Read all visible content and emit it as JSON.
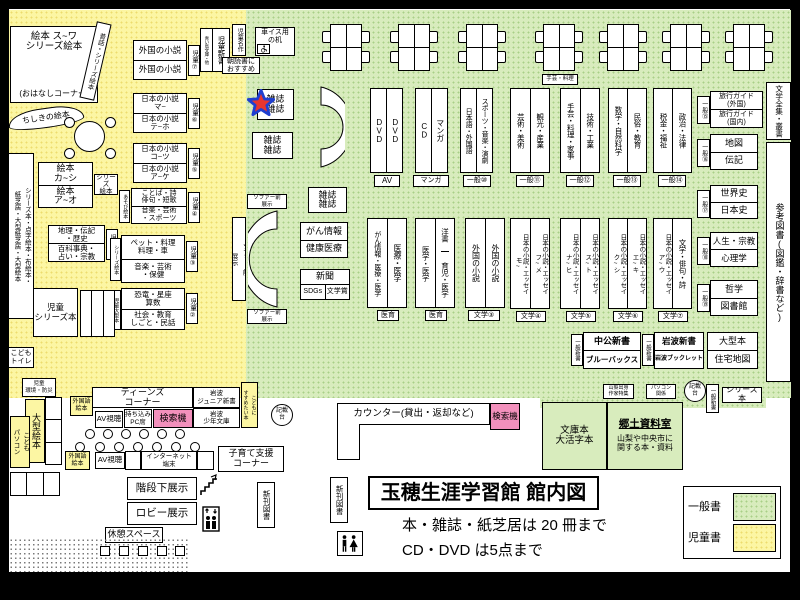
{
  "colors": {
    "yellow": "#FCF6A3",
    "green": "#D8ECBD",
    "pink": "#F290BC",
    "star_red": "#E8362E",
    "star_blue": "#1F3FD0"
  },
  "legend": {
    "general": "一般書",
    "children": "児童書"
  },
  "title": {
    "main": "玉穂生涯学習館 館内図",
    "note1": "本・雑誌・紙芝居は 20 冊まで",
    "note2": "CD・DVD は5点まで"
  },
  "icons": {
    "star": "you-are-here-star",
    "wheelchair": "wheelchair",
    "stairs": "stairs",
    "elevator": "elevator",
    "restroom": "restroom",
    "sofa": "crescent-sofa"
  },
  "kids": {
    "ehon_suwa": "絵本 ス~ワ\nシリーズ絵本",
    "ohanashi": "(おはなしコーナー)",
    "mukashibanashi": "昔話・シリーズ絵本",
    "chishiki": "ちしきの絵本",
    "gaikoku1": "外国の小説",
    "gaikoku2": "外国の小説",
    "b7": "児童⑦",
    "shinsho_sub": "青い鳥文庫・他",
    "shinsho": "児童新書",
    "meisaku": "児童名作",
    "asadoku": "朝読書に\nおすすめ",
    "jp_ma": "日本の小説\nマ~",
    "jp_teho": "日本の小説\nテ~ホ",
    "b6": "児童⑥",
    "jp_kotsu": "日本の小説\nコ~ツ",
    "jp_ake": "日本の小説\nア~ケ",
    "b5": "児童⑤",
    "kotoba1": "ことば・詩\n俳句・短歌",
    "kotoba2": "音楽・芸術\n・スポーツ",
    "asobi": "あそび絵本",
    "b4": "児童④",
    "ehon_ka": "絵本\nカ~シ",
    "ehon_a": "絵本\nア~オ",
    "series_ehon": "シリーズ\n絵本",
    "chiri1": "地理・伝記\n・歴史",
    "chiri2": "百科事典・\n占い・宗教",
    "b1": "児童①",
    "pet1": "ペット・料理\n料理・車",
    "pet2": "音楽・芸術\n・保健",
    "series_ehon_v": "シリーズ絵本",
    "b3": "児童③",
    "kyoryu1": "恐竜・星座\n算数",
    "kyoryu2": "社会・教育\nしごと・民話",
    "ogata_v": "児童大型本",
    "b2": "児童②",
    "jido_series": "児童\nシリーズ本",
    "left_wall": "シリーズ本・点字絵本・布絵本・\n紙芝居・大型紙芝居・大型絵本",
    "toilet": "こども\nトイレ",
    "sofa_side": "ソファー前\n展示"
  },
  "center": {
    "wheelchair": "車イス用\nの机",
    "mag": "雑誌\n雑誌",
    "sofa_label": "ソファー前\n展示",
    "gan1": "がん情報",
    "gan2": "健康医療",
    "shinbun": "新聞",
    "sdgs": "SDGs",
    "bungakusho": "文学賞",
    "shugei": "手芸・料理"
  },
  "shelves_top": [
    {
      "c1": "DVD",
      "c2": "DVD",
      "label": "AV"
    },
    {
      "c1": "CD",
      "c2": "マンガ",
      "label": "マンガ"
    },
    {
      "c1": "日本語・外国語",
      "c2": "スポーツ・音楽・演劇",
      "label": "一般⑩"
    },
    {
      "c1": "芸術・美術",
      "c2": "観光・産業",
      "label": "一般⑪"
    },
    {
      "c1": "手芸・料理・家事",
      "c2": "技術・工業",
      "label": "一般⑫"
    },
    {
      "c1": "数学・自然科学",
      "c2": "民俗・教育",
      "label": "一般⑬"
    },
    {
      "c1": "税金・福祉",
      "c2": "政治・法律",
      "label": "一般⑭"
    }
  ],
  "shelves_mid": [
    {
      "c1": "がん情報・医療・医学",
      "c2": "医療・医学",
      "label": "医育"
    },
    {
      "c1": "医学・医学",
      "c2a": "洋書",
      "c2b": "育児・医学",
      "label": "医育"
    },
    {
      "c1": "外国の小説",
      "c2": "外国の小説",
      "label": "文学③"
    },
    {
      "c1": "日本の小説・エッセイ\nモ~",
      "c2": "日本の小説・エッセイ\nフ~メ",
      "label": "文学④"
    },
    {
      "c1": "日本の小説・エッセイ\nナ~ヒ",
      "c2": "日本の小説・エッセイ\nス~ト",
      "label": "文学⑤"
    },
    {
      "c1": "日本の小説・エッセイ\nク~シ",
      "c2": "日本の小説・エッセイ\nエ~キ",
      "label": "文学⑥"
    },
    {
      "c1": "日本の小説・エッセイ\nア~ウ",
      "c2": "文学・俳句・詩",
      "label": "文学⑦"
    }
  ],
  "east": {
    "g15": {
      "badge": "一般⑮",
      "r1": "旅行ガイド\n(外国)",
      "r2": "旅行ガイド\n(国内)"
    },
    "g16": {
      "badge": "一般⑯",
      "r1": "地図",
      "r2": "伝記"
    },
    "g17": {
      "badge": "一般⑰",
      "r1": "世界史",
      "r2": "日本史"
    },
    "g18": {
      "badge": "一般⑱",
      "r1": "人生・宗教",
      "r2": "心理学"
    },
    "g19": {
      "badge": "一般⑲",
      "r1": "哲学",
      "r2": "図書館"
    },
    "zenshu": "文学全集・叢書",
    "sanko": "参考図書(図鑑・辞書など)"
  },
  "shinsho": {
    "badge1": "一般新書",
    "chuko1": "中公新書",
    "chuko2": "ブルーバックス",
    "badge2": "一般新書",
    "iwa1": "岩波新書",
    "iwa2": "岩波ブックレット",
    "ogata1": "大型本",
    "ogata2": "住宅地図"
  },
  "se": {
    "yamanashi": "山梨出身\n作家特集",
    "pc": "パソコン\n関係",
    "kisaidai": "記載\n台",
    "shinsho_v": "一般新書",
    "series": "シリーズ本",
    "bunko": "文庫本\n大活字本",
    "kyodo_title": "郷土資料室",
    "kyodo_desc": "山梨や中央市に\n関する本・資料"
  },
  "counter": {
    "kisaidai": "記載\n台",
    "label": "カウンター(貸出・返却など)",
    "kensaku": "検索機",
    "shinkan": "新刊図書"
  },
  "teens": {
    "kankyo": "児童\n環境・防災",
    "ogata_ehon": "大型絵本",
    "kodomo_pc": "こども\nパソコン",
    "header": "ティーンズ\nコーナー",
    "gaikokugo1": "外国語\n絵本",
    "av1": "AV視聴",
    "pc_seki": "持ち込み\nPC席",
    "kensaku": "検索機",
    "iwanami_jr": "岩波\nジュニア新書",
    "iwanami_shonen": "岩波\n少年文庫",
    "kodomoni": "こどもに\nすすめたい本",
    "gaikokugo2": "外国語\n絵本",
    "av2": "AV視聴",
    "internet": "インターネット\n端末",
    "kosodate": "子育て支援\nコーナー",
    "kaidan": "階段下展示",
    "lobby": "ロビー展示",
    "kyukei": "休憩スペース"
  }
}
